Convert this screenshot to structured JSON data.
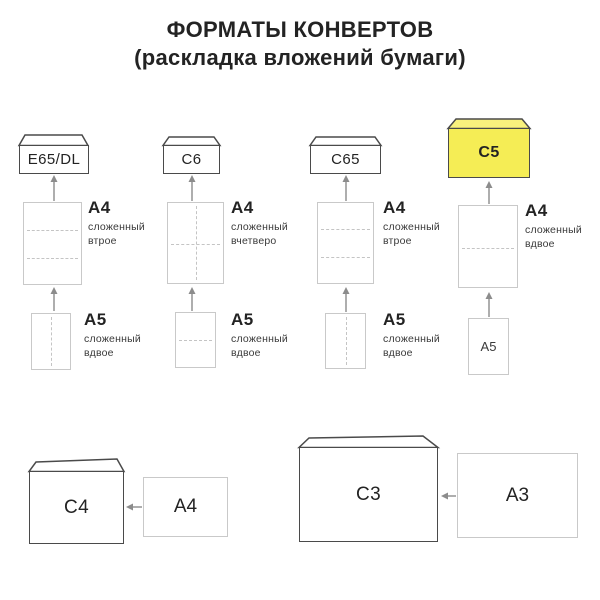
{
  "title": {
    "line1": "ФОРМАТЫ КОНВЕРТОВ",
    "line2": "(раскладка вложений бумаги)"
  },
  "palette": {
    "highlight_fill": "#f5ed55",
    "highlight_flap": "#f8f17d",
    "envelope_border": "#4a4a4a",
    "sheet_border": "#c9c9c9",
    "fold_dash": "#c4c4c4",
    "arrow": "#8c8c8c",
    "seam": "#b5b5b5",
    "seam_highlight": "#ddd45a",
    "text_primary": "#232323",
    "text_secondary": "#3a3a3a"
  },
  "columns": [
    {
      "envelope": "E65/DL",
      "highlight": false,
      "a4_code": "A4",
      "a4_fold": [
        "сложенный",
        "втрое"
      ],
      "a5_code": "A5",
      "a5_fold": [
        "сложенный",
        "вдвое"
      ]
    },
    {
      "envelope": "C6",
      "highlight": false,
      "a4_code": "A4",
      "a4_fold": [
        "сложенный",
        "вчетверо"
      ],
      "a5_code": "A5",
      "a5_fold": [
        "сложенный",
        "вдвое"
      ]
    },
    {
      "envelope": "C65",
      "highlight": false,
      "a4_code": "A4",
      "a4_fold": [
        "сложенный",
        "втрое"
      ],
      "a5_code": "A5",
      "a5_fold": [
        "сложенный",
        "вдвое"
      ]
    },
    {
      "envelope": "C5",
      "highlight": true,
      "a4_code": "A4",
      "a4_fold": [
        "сложенный",
        "вдвое"
      ],
      "a5_code": "A5"
    }
  ],
  "bottom_row": [
    {
      "envelope": "C4",
      "sheet": "A4"
    },
    {
      "envelope": "C3",
      "sheet": "A3"
    }
  ]
}
